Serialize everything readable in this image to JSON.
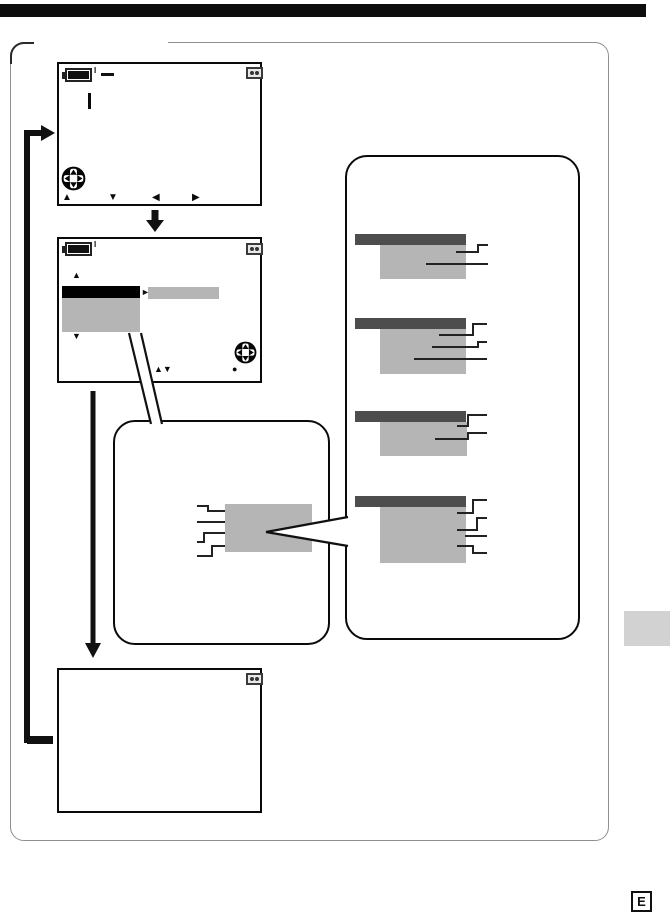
{
  "glyphs": {
    "up_arrow": "▲",
    "down_arrow": "▼",
    "left_arrow": "◀",
    "right_arrow": "▶",
    "up_down_arrows": "▲▼",
    "execute_dot": "●",
    "menu_pointer": "►",
    "battery_mark": "I"
  },
  "edition_badge": {
    "label": "E"
  },
  "colors": {
    "title_bar": "#0d0d0d",
    "menu_highlight": "#000000",
    "menu_gray": "#b5b5b5",
    "group_header_gray": "#4d4d4d",
    "side_tab_gray": "#d2d2d2",
    "frame_border_gray": "#8f8f8f"
  },
  "icons": {
    "battery_icon": "battery-with-level-fill",
    "tape_icon": "boxed-cassette-hubs",
    "dpad_icon": "four-way-control-button"
  },
  "screens": {
    "screen1": {
      "nav_hints": [
        "▲",
        "▼",
        "◀",
        "▶"
      ]
    },
    "screen2": {
      "hints": [
        "▲▼",
        "●"
      ]
    },
    "screen3": {}
  },
  "option_groups": [
    {
      "option_lines": 2
    },
    {
      "option_lines": 3
    },
    {
      "option_lines": 2
    },
    {
      "option_lines": 4
    }
  ]
}
